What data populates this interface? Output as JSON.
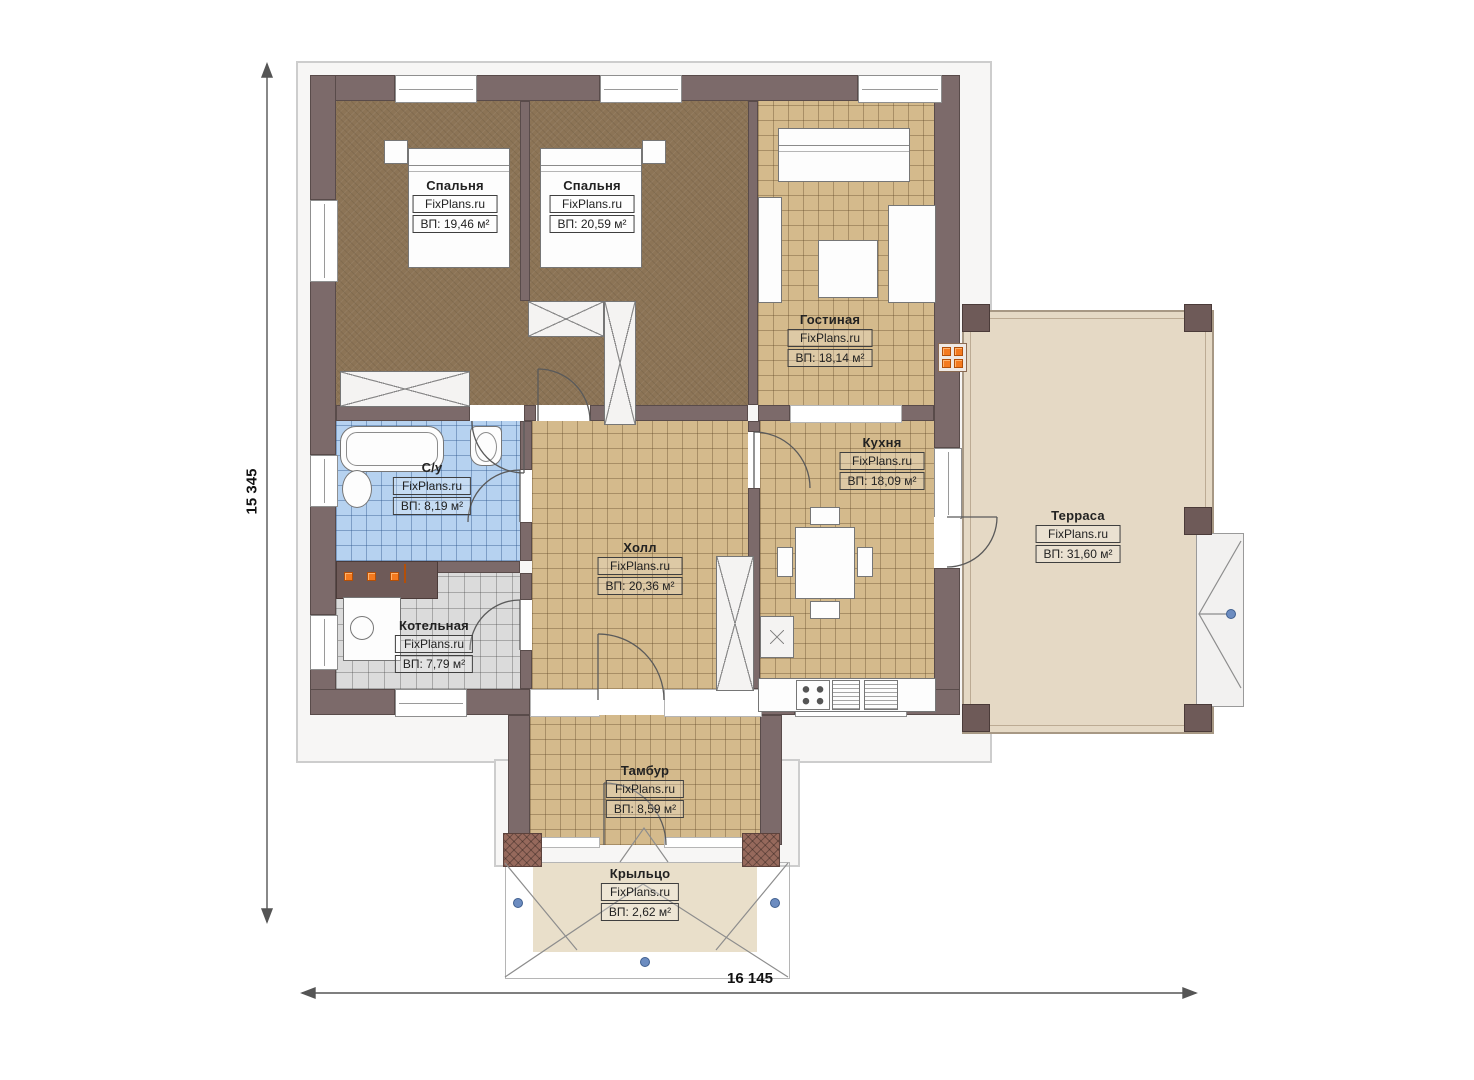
{
  "plan": {
    "brand": "FixPlans.ru",
    "dimensions": {
      "height_mm": "15 345",
      "width_mm": "16 145"
    },
    "rooms": [
      {
        "id": "bedroom-1",
        "name": "Спальня",
        "area": "ВП: 19,46 м²"
      },
      {
        "id": "bedroom-2",
        "name": "Спальня",
        "area": "ВП: 20,59 м²"
      },
      {
        "id": "living",
        "name": "Гостиная",
        "area": "ВП: 18,14 м²"
      },
      {
        "id": "bathroom",
        "name": "С/у",
        "area": "ВП: 8,19 м²"
      },
      {
        "id": "kitchen",
        "name": "Кухня",
        "area": "ВП: 18,09 м²"
      },
      {
        "id": "hall",
        "name": "Холл",
        "area": "ВП: 20,36 м²"
      },
      {
        "id": "boiler",
        "name": "Котельная",
        "area": "ВП: 7,79 м²"
      },
      {
        "id": "terrace",
        "name": "Терраса",
        "area": "ВП: 31,60 м²"
      },
      {
        "id": "vestibule",
        "name": "Тамбур",
        "area": "ВП: 8,59 м²"
      },
      {
        "id": "porch",
        "name": "Крыльцо",
        "area": "ВП: 2,62 м²"
      }
    ],
    "colors": {
      "wall": "#7c6a6a",
      "bedroom_floor": "#8c7456",
      "tile_floor": "#d4ba8c",
      "bath_floor": "#b6d2f0",
      "boiler_floor": "#dbdbdb",
      "terrace_floor": "#e5d9c5",
      "radiator_orange": "#f47a1f",
      "marker_blue": "#6c8cc0"
    }
  }
}
